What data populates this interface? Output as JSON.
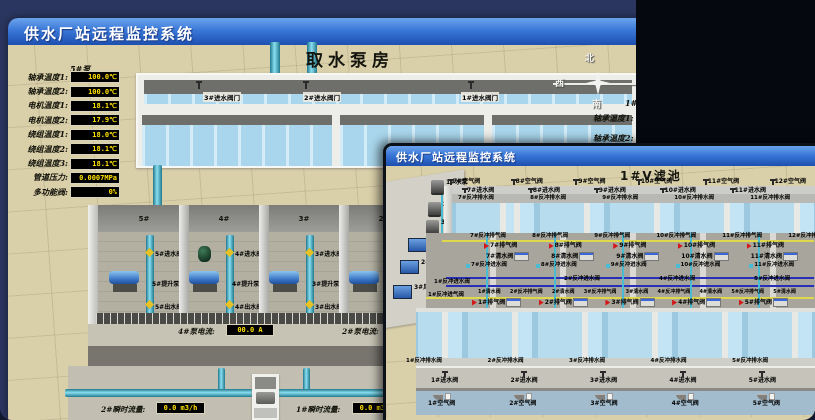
{
  "colors": {
    "titlebar_blue": "#2f6ed4",
    "value_yellow": "#ffe100",
    "alarm_red": "#d41818",
    "pipe_teal": "#4ab8cc",
    "air_line_yellow": "#ded84a",
    "water_line_blue": "#2830b8",
    "floor_beige": "#d9cfa9"
  },
  "back_window": {
    "title": "供水厂站远程监控系统",
    "scene_title": "取水泵房",
    "pump_panel": {
      "title": "5#泵",
      "rows": [
        {
          "label": "轴承温度1:",
          "value": "100.0℃"
        },
        {
          "label": "轴承温度2:",
          "value": "100.0℃"
        },
        {
          "label": "电机温度1:",
          "value": "18.1℃"
        },
        {
          "label": "电机温度2:",
          "value": "17.9℃"
        },
        {
          "label": "绕组温度1:",
          "value": "18.0℃"
        },
        {
          "label": "绕组温度2:",
          "value": "18.1℃"
        },
        {
          "label": "绕组温度3:",
          "value": "18.1℃"
        },
        {
          "label": "管道压力:",
          "value": "0.0007MPa"
        },
        {
          "label": "多功能阀:",
          "value": "0%"
        }
      ]
    },
    "inlet_gate_valves": [
      "3#进水阀门",
      "2#进水阀门",
      "1#进水阀门"
    ],
    "bay_numbers": [
      "5#",
      "4#",
      "3#",
      "2#"
    ],
    "bays": [
      {
        "inlet": "5#进水阀",
        "pump": "5#提升泵",
        "outlet": "5#出水阀"
      },
      {
        "inlet": "4#进水阀",
        "pump": "4#提升泵",
        "outlet": "4#出水阀"
      },
      {
        "inlet": "3#进水阀",
        "pump": "3#提升泵",
        "outlet": "3#出水阀"
      },
      {
        "inlet": "",
        "pump": "",
        "outlet": ""
      }
    ],
    "pump_current": {
      "label": "4#泵电流:",
      "value": "00.0 A"
    },
    "pump_current_2_label": "2#泵电流:",
    "flow_meters": [
      {
        "label": "2#瞬时流量:",
        "value": "0.0 m3/h"
      },
      {
        "label": "1#瞬时流量:",
        "value": "0.0 m3/h"
      }
    ],
    "compass": {
      "north": "北",
      "west": "西",
      "south": "南"
    },
    "right_panel": {
      "title": "1#泵",
      "rows": [
        "轴承温度1:",
        "轴承温度2:"
      ]
    }
  },
  "front_window": {
    "title": "供水厂站远程监控系统",
    "scene_title": "1#V滤池",
    "machine_pumps": [
      "1#水泵",
      "2#水泵",
      "3#水泵"
    ],
    "machine_blowers": [
      "1#风机",
      "2#风机",
      "3#风机"
    ],
    "top_air_valves": [
      "7#空气阀",
      "8#空气阀",
      "9#空气阀",
      "10#空气阀",
      "11#空气阀",
      "12#空气阀"
    ],
    "top_inlet_valves": [
      "7#进水阀",
      "8#进水阀",
      "9#进水阀",
      "10#进水阀",
      "11#进水阀"
    ],
    "top_drain_valves": [
      "7#反冲排水阀",
      "8#反冲排水阀",
      "9#反冲排水阀",
      "10#反冲排水阀",
      "11#反冲排水阀"
    ],
    "backwash_air_valves_top": [
      "7#反冲排气阀",
      "8#反冲排气阀",
      "9#反冲排气阀",
      "10#反冲排气阀",
      "11#反冲排气阀",
      "12#反冲排气阀"
    ],
    "exhaust_valves_top": [
      "7#排气阀",
      "8#排气阀",
      "9#排气阀",
      "10#排气阀",
      "11#排气阀"
    ],
    "clean_water_valves_top": [
      "7#清水阀",
      "8#清水阀",
      "9#清水阀",
      "10#清水阀",
      "11#清水阀"
    ],
    "backwash_water_valves_top": [
      "7#反冲进水阀",
      "8#反冲进水阀",
      "9#反冲进水阀",
      "10#反冲进水阀",
      "11#反冲进水阀"
    ],
    "backwash_water_valves_center": [
      "2#反冲进水阀",
      "4#反冲进水阀",
      "5#反冲进水阀"
    ],
    "left_edge_labels": [
      "1#反冲进水阀",
      "1#反冲进气阀"
    ],
    "gallery_line_labels": [
      "1#清水阀",
      "2#反冲排气阀",
      "2#清水阀",
      "3#反冲排气阀",
      "3#清水阀",
      "4#反冲排气阀",
      "4#清水阀",
      "5#反冲排气阀",
      "5#清水阀"
    ],
    "exhaust_valves_bottom": [
      "1#排气阀",
      "2#排气阀",
      "3#排气阀",
      "4#排气阀",
      "5#排气阀"
    ],
    "bottom_drain_valves": [
      "1#反冲排水阀",
      "2#反冲排水阀",
      "3#反冲排水阀",
      "4#反冲排水阀",
      "5#反冲排水阀"
    ],
    "bottom_inlet_valves": [
      "1#进水阀",
      "2#进水阀",
      "3#进水阀",
      "4#进水阀",
      "5#进水阀"
    ],
    "bottom_air_valves": [
      "1#空气阀",
      "2#空气阀",
      "3#空气阀",
      "4#空气阀",
      "5#空气阀"
    ]
  }
}
